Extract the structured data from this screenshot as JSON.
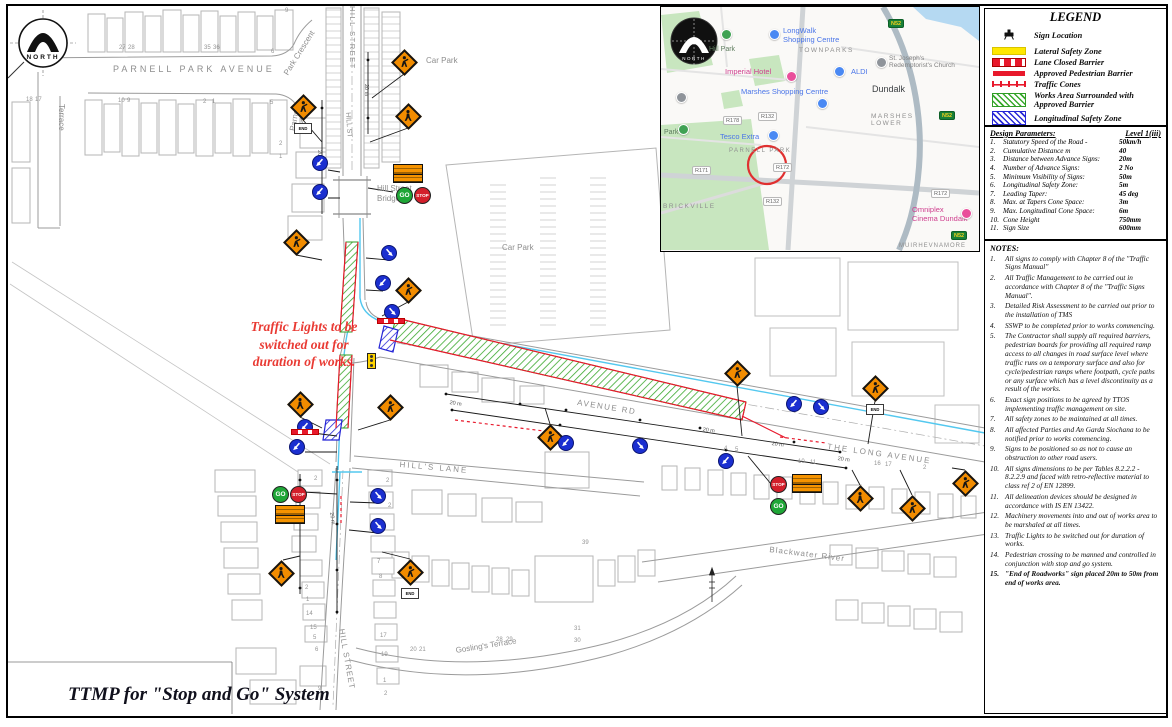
{
  "title_block": {
    "title": "TTMP for \"Stop and Go\" System"
  },
  "legend": {
    "title": "LEGEND",
    "items": [
      {
        "swatch": "sign-location",
        "label": "Sign Location"
      },
      {
        "swatch": "lateral",
        "label": "Lateral Safety Zone"
      },
      {
        "swatch": "lane-closed",
        "label": "Lane Closed Barrier"
      },
      {
        "swatch": "ped-barrier",
        "label": "Approved Pedestrian Barrier"
      },
      {
        "swatch": "cones",
        "label": "Traffic Cones"
      },
      {
        "swatch": "works-area",
        "label": "Works Area Surrounded with\nApproved Barrier"
      },
      {
        "swatch": "long-zone",
        "label": "Longitudinal Safety Zone"
      }
    ]
  },
  "design_parameters": {
    "title": "Design Parameters:",
    "level": "Level 1(iii)",
    "rows": [
      {
        "num": "1.",
        "label": "Statutory Speed of the Road -",
        "value": "50km/h"
      },
      {
        "num": "2.",
        "label": "Cumulative Distance m",
        "value": "40"
      },
      {
        "num": "3.",
        "label": "Distance between Advance Signs:",
        "value": "20m"
      },
      {
        "num": "4.",
        "label": "Number of Advance Signs:",
        "value": "2 No"
      },
      {
        "num": "5.",
        "label": "Minimum Visibility of Signs:",
        "value": "50m"
      },
      {
        "num": "6.",
        "label": "Longitudinal Safety Zone:",
        "value": "5m"
      },
      {
        "num": "7.",
        "label": "Leading Taper:",
        "value": "45 deg"
      },
      {
        "num": "8.",
        "label": "Max. at Tapers Cone Space:",
        "value": "3m"
      },
      {
        "num": "9.",
        "label": "Max. Longitudinal Cone Space:",
        "value": "6m"
      },
      {
        "num": "10.",
        "label": "Cone Height",
        "value": "750mm"
      },
      {
        "num": "11.",
        "label": "Sign Size",
        "value": "600mm"
      }
    ]
  },
  "notes": {
    "title": "NOTES:",
    "items": [
      {
        "num": "1.",
        "text": "All signs to comply with Chapter 8 of the \"Traffic Signs Manual\""
      },
      {
        "num": "2.",
        "text": "All Traffic Management to be carried out in accordance with Chapter 8 of the \"Traffic Signs Manual\"."
      },
      {
        "num": "3.",
        "text": "Detailed Risk Assessment to be carried out prior to the installation of TMS"
      },
      {
        "num": "4.",
        "text": "SSWP to be completed prior to works commencing."
      },
      {
        "num": "5.",
        "text": "The Contractor shall supply all required barriers, pedestrian boards for providing all required ramp access to all changes in road surface level where traffic runs on a temporary surface and also for cycle/pedestrian ramps where footpath, cycle paths or any surface which has a level discontinuity as a result of the works."
      },
      {
        "num": "6.",
        "text": "Exact sign positions to be agreed by TTOS implementing traffic management on site."
      },
      {
        "num": "7.",
        "text": "All safety zones to be maintained at all times."
      },
      {
        "num": "8.",
        "text": "All affected Parties and An Garda Siochana to be notified prior to works commencing."
      },
      {
        "num": "9.",
        "text": "Signs to be positioned so as not to cause an obstruction to other road users."
      },
      {
        "num": "10.",
        "text": "All signs dimensions to be per Tables 8.2.2.2 - 8.2.2.9 and faced with retro-reflective material to class ref 2 of EN 12899."
      },
      {
        "num": "11.",
        "text": "All delineation devices should be designed in accordance with IS EN 13422."
      },
      {
        "num": "12.",
        "text": "Machinery movements into and out of works area to be marshaled at all times."
      },
      {
        "num": "13.",
        "text": "Traffic Lights to be switched out for duration of works."
      },
      {
        "num": "14.",
        "text": "Pedestrian crossing to be manned and controlled in conjunction with stop and go system."
      },
      {
        "num": "15.",
        "text": "\"End of Roadworks\" sign placed 20m to 50m from end of works area.",
        "bold": true
      }
    ]
  },
  "drawing": {
    "traffic_note": "Traffic Lights to be\nswitched out for\nduration of works.",
    "go_label": "GO",
    "stop_label": "STOP",
    "end_plate_label": "END",
    "dim_label": "20 m",
    "street_labels": [
      {
        "t": "PARNELL PARK AVENUE",
        "x": 113,
        "y": 64,
        "fs": 9,
        "ls": 3
      },
      {
        "t": "Terrace",
        "x": 66,
        "y": 104,
        "r": 90,
        "fs": 8
      },
      {
        "t": "Park Crescent",
        "x": 282,
        "y": 72,
        "r": -58,
        "fs": 8
      },
      {
        "t": "Parnell",
        "x": 288,
        "y": 130,
        "r": -80,
        "fs": 8
      },
      {
        "t": "HILL STREET",
        "x": 356,
        "y": 6,
        "r": 90,
        "fs": 7.5,
        "ls": 1.5
      },
      {
        "t": "HILL ST",
        "x": 351,
        "y": 112,
        "r": 86,
        "fs": 7
      },
      {
        "t": "Car Park",
        "x": 426,
        "y": 56,
        "fs": 8
      },
      {
        "t": "Car Park",
        "x": 502,
        "y": 243,
        "fs": 8
      },
      {
        "t": "Hill Street",
        "x": 377,
        "y": 184,
        "fs": 8
      },
      {
        "t": "Bridge",
        "x": 377,
        "y": 194,
        "fs": 8
      },
      {
        "t": "HILL'S LANE",
        "x": 400,
        "y": 460,
        "r": 5,
        "fs": 8,
        "ls": 2
      },
      {
        "t": "AVENUE RD",
        "x": 578,
        "y": 398,
        "r": 9,
        "fs": 8,
        "ls": 1.5
      },
      {
        "t": "THE LONG AVENUE",
        "x": 828,
        "y": 442,
        "r": 8,
        "fs": 8,
        "ls": 2
      },
      {
        "t": "Gosling's Terrace",
        "x": 455,
        "y": 646,
        "r": -9,
        "fs": 8
      },
      {
        "t": "Blackwater River",
        "x": 770,
        "y": 545,
        "r": 7,
        "fs": 8,
        "ls": 1
      },
      {
        "t": "HILL STREET",
        "x": 346,
        "y": 628,
        "r": 80,
        "fs": 8,
        "ls": 1
      }
    ],
    "house_numbers": [
      [
        "27",
        119,
        45
      ],
      [
        "28",
        128,
        45
      ],
      [
        "35",
        204,
        45
      ],
      [
        "36",
        213,
        45
      ],
      [
        "9",
        285,
        8
      ],
      [
        "6",
        271,
        49
      ],
      [
        "18",
        26,
        97
      ],
      [
        "17",
        35,
        97
      ],
      [
        "10",
        118,
        98
      ],
      [
        "9",
        127,
        98
      ],
      [
        "2",
        203,
        99
      ],
      [
        "1",
        212,
        99
      ],
      [
        "5",
        270,
        100
      ],
      [
        "2",
        279,
        141
      ],
      [
        "1",
        279,
        154
      ],
      [
        "2",
        314,
        476
      ],
      [
        "2",
        386,
        478
      ],
      [
        "2",
        388,
        503
      ],
      [
        "7",
        377,
        559
      ],
      [
        "8",
        379,
        574
      ],
      [
        "17",
        380,
        633
      ],
      [
        "19",
        381,
        652
      ],
      [
        "20",
        410,
        647
      ],
      [
        "21",
        419,
        647
      ],
      [
        "28",
        496,
        637
      ],
      [
        "29",
        506,
        637
      ],
      [
        "31",
        574,
        626
      ],
      [
        "30",
        574,
        638
      ],
      [
        "39",
        582,
        540
      ],
      [
        "2",
        305,
        585
      ],
      [
        "1",
        306,
        597
      ],
      [
        "14",
        306,
        611
      ],
      [
        "15",
        310,
        625
      ],
      [
        "5",
        313,
        635
      ],
      [
        "6",
        315,
        647
      ],
      [
        "9",
        318,
        686
      ],
      [
        "1",
        383,
        678
      ],
      [
        "2",
        384,
        691
      ],
      [
        "4",
        724,
        446
      ],
      [
        "5",
        735,
        447
      ],
      [
        "10",
        798,
        459
      ],
      [
        "11",
        810,
        460
      ],
      [
        "16",
        874,
        461
      ],
      [
        "17",
        885,
        462
      ],
      [
        "2",
        923,
        465
      ]
    ],
    "dims": [
      [
        369,
        84,
        90
      ],
      [
        322,
        150,
        88
      ],
      [
        334,
        512,
        82
      ],
      [
        450,
        400,
        9
      ],
      [
        703,
        427,
        8
      ],
      [
        772,
        441,
        8
      ],
      [
        838,
        456,
        8
      ]
    ],
    "diamonds": [
      {
        "x": 404,
        "y": 62,
        "g": "w"
      },
      {
        "x": 408,
        "y": 116,
        "g": "p"
      },
      {
        "x": 303,
        "y": 107,
        "g": "w"
      },
      {
        "x": 296,
        "y": 242,
        "g": "w"
      },
      {
        "x": 408,
        "y": 290,
        "g": "w"
      },
      {
        "x": 390,
        "y": 407,
        "g": "w"
      },
      {
        "x": 300,
        "y": 404,
        "g": "p"
      },
      {
        "x": 281,
        "y": 573,
        "g": "p"
      },
      {
        "x": 410,
        "y": 572,
        "g": "w"
      },
      {
        "x": 550,
        "y": 437,
        "g": "w"
      },
      {
        "x": 737,
        "y": 373,
        "g": "w"
      },
      {
        "x": 875,
        "y": 388,
        "g": "w"
      },
      {
        "x": 860,
        "y": 498,
        "g": "p"
      },
      {
        "x": 912,
        "y": 508,
        "g": "w"
      },
      {
        "x": 965,
        "y": 483,
        "g": "w"
      }
    ],
    "end_plates": [
      [
        303,
        123
      ],
      [
        875,
        404
      ],
      [
        410,
        588
      ]
    ],
    "keep_left": [
      [
        320,
        163,
        0
      ],
      [
        320,
        192,
        0
      ],
      [
        389,
        253,
        1
      ],
      [
        383,
        283,
        0
      ],
      [
        392,
        312,
        1
      ],
      [
        305,
        427,
        0
      ],
      [
        297,
        447,
        0
      ],
      [
        378,
        496,
        1
      ],
      [
        378,
        526,
        1
      ],
      [
        566,
        443,
        0
      ],
      [
        640,
        446,
        1
      ],
      [
        794,
        404,
        0
      ],
      [
        821,
        407,
        1
      ],
      [
        726,
        461,
        0
      ]
    ],
    "stop_go_groups": [
      {
        "go": [
          396,
          187
        ],
        "stop": [
          414,
          187
        ],
        "board": [
          393,
          164
        ]
      },
      {
        "go": [
          272,
          486
        ],
        "stop": [
          290,
          486
        ],
        "board": [
          275,
          505
        ]
      },
      {
        "stop": [
          770,
          476
        ],
        "go": [
          770,
          498
        ],
        "board": [
          792,
          474
        ]
      }
    ],
    "signals": [
      [
        367,
        353
      ]
    ],
    "lane_closed_bars": [
      [
        377,
        318
      ],
      [
        291,
        429
      ]
    ]
  },
  "inset": {
    "labels": [
      {
        "t": "LongWalk\nShopping Centre",
        "x": 122,
        "y": 20,
        "c": "blue",
        "fs": 7.5
      },
      {
        "t": "TOWNPARKS",
        "x": 138,
        "y": 40,
        "c": "area",
        "fs": 6.5,
        "ls": 1.5
      },
      {
        "t": "Hill Park",
        "x": 48,
        "y": 39,
        "c": "park",
        "fs": 7
      },
      {
        "t": "Imperial Hotel",
        "x": 64,
        "y": 61,
        "c": "pink",
        "fs": 7.5
      },
      {
        "t": "ALDI",
        "x": 190,
        "y": 61,
        "c": "blue",
        "fs": 7.5
      },
      {
        "t": "Marshes Shopping Centre",
        "x": 80,
        "y": 81,
        "c": "blue",
        "fs": 7.5
      },
      {
        "t": "Dundalk",
        "x": 211,
        "y": 77,
        "c": "city",
        "fs": 9
      },
      {
        "t": "St. Joseph's\nRedemptorist's Church",
        "x": 228,
        "y": 48,
        "c": "area2",
        "fs": 6.5
      },
      {
        "t": "MARSHES\nLOWER",
        "x": 210,
        "y": 106,
        "c": "area",
        "fs": 6.5,
        "ls": 1.5
      },
      {
        "t": "Tesco Extra",
        "x": 59,
        "y": 126,
        "c": "blue",
        "fs": 7.5
      },
      {
        "t": "PARNELL PARK",
        "x": 68,
        "y": 141,
        "c": "area",
        "fs": 6,
        "ls": 1.5
      },
      {
        "t": "BRICKVILLE",
        "x": 2,
        "y": 196,
        "c": "area",
        "fs": 6.5,
        "ls": 1.5
      },
      {
        "t": "Omniplex\nCinema Dundalk",
        "x": 251,
        "y": 199,
        "c": "pink",
        "fs": 7.5
      },
      {
        "t": "MUIRHEVNAMORE",
        "x": 238,
        "y": 236,
        "c": "area",
        "fs": 6,
        "ls": 1
      },
      {
        "t": "Park",
        "x": 3,
        "y": 122,
        "c": "park",
        "fs": 7
      }
    ],
    "badges": [
      {
        "t": "N52",
        "x": 227,
        "y": 12,
        "k": "n"
      },
      {
        "t": "N52",
        "x": 278,
        "y": 104,
        "k": "n"
      },
      {
        "t": "N52",
        "x": 290,
        "y": 224,
        "k": "n"
      },
      {
        "t": "R178",
        "x": 62,
        "y": 109,
        "k": "r"
      },
      {
        "t": "R132",
        "x": 97,
        "y": 105,
        "k": "r"
      },
      {
        "t": "R132",
        "x": 102,
        "y": 190,
        "k": "r"
      },
      {
        "t": "R171",
        "x": 31,
        "y": 159,
        "k": "r"
      },
      {
        "t": "R172",
        "x": 112,
        "y": 156,
        "k": "r"
      },
      {
        "t": "R172",
        "x": 270,
        "y": 182,
        "k": "r"
      }
    ],
    "pois": [
      [
        108,
        22,
        "#4a89f3"
      ],
      [
        60,
        22,
        "#3fa253"
      ],
      [
        125,
        64,
        "#e94f9b"
      ],
      [
        173,
        59,
        "#4a89f3"
      ],
      [
        156,
        91,
        "#4a89f3"
      ],
      [
        215,
        50,
        "#8f949a"
      ],
      [
        107,
        123,
        "#4a89f3"
      ],
      [
        17,
        117,
        "#3fa253"
      ],
      [
        300,
        201,
        "#e94f9b"
      ],
      [
        15,
        85,
        "#8f949a"
      ]
    ]
  }
}
